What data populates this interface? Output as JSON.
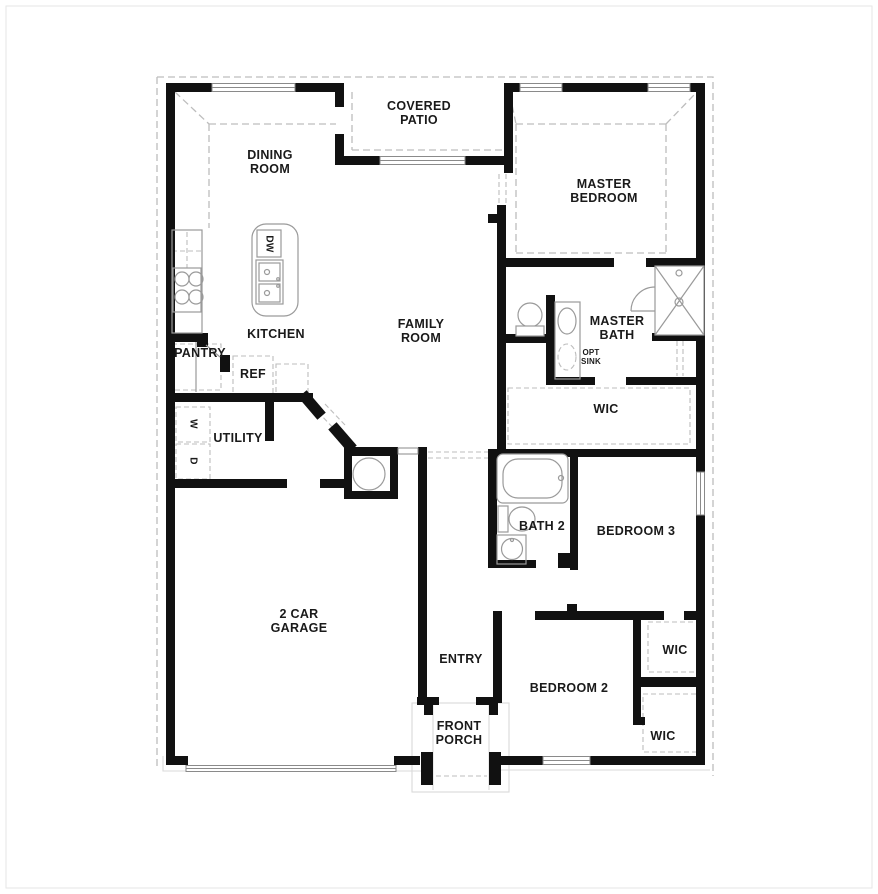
{
  "title": "Single-story home floor plan",
  "colors": {
    "wall": "#111111",
    "fixture": "#9a9a9a",
    "dashed": "#bdbdbd",
    "text": "#1a1a1a"
  },
  "rooms": [
    {
      "id": "covered-patio",
      "label": "COVERED\nPATIO"
    },
    {
      "id": "dining-room",
      "label": "DINING\nROOM"
    },
    {
      "id": "master-bedroom",
      "label": "MASTER\nBEDROOM"
    },
    {
      "id": "kitchen",
      "label": "KITCHEN"
    },
    {
      "id": "family-room",
      "label": "FAMILY\nROOM"
    },
    {
      "id": "master-bath",
      "label": "MASTER\nBATH"
    },
    {
      "id": "pantry",
      "label": "PANTRY"
    },
    {
      "id": "utility",
      "label": "UTILITY"
    },
    {
      "id": "wic-master",
      "label": "WIC"
    },
    {
      "id": "bath-2",
      "label": "BATH 2"
    },
    {
      "id": "bedroom-3",
      "label": "BEDROOM 3"
    },
    {
      "id": "garage",
      "label": "2 CAR\nGARAGE"
    },
    {
      "id": "entry",
      "label": "ENTRY"
    },
    {
      "id": "bedroom-2",
      "label": "BEDROOM 2"
    },
    {
      "id": "wic-bedroom-3",
      "label": "WIC"
    },
    {
      "id": "wic-bedroom-2",
      "label": "WIC"
    },
    {
      "id": "front-porch",
      "label": "FRONT\nPORCH"
    }
  ],
  "fixtures": {
    "dishwasher": "DW",
    "refrigerator": "REF",
    "washer": "W",
    "dryer": "D",
    "optional_sink": "OPT\nSINK"
  }
}
